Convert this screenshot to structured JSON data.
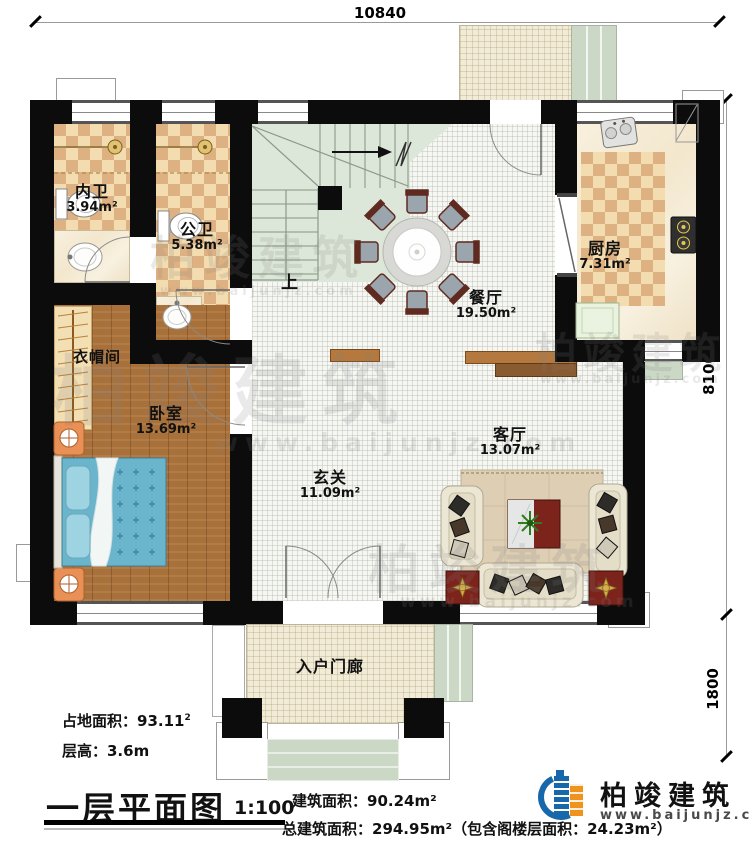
{
  "dims": {
    "top": "10840",
    "right_up": "8100",
    "right_low": "1800"
  },
  "rooms": [
    {
      "name": "内卫",
      "area": "3.94m²"
    },
    {
      "name": "公卫",
      "area": "5.38m²"
    },
    {
      "name": "厨房",
      "area": "7.31m²"
    },
    {
      "name": "餐厅",
      "area": "19.50m²"
    },
    {
      "name": "衣帽间",
      "area": ""
    },
    {
      "name": "卧室",
      "area": "13.69m²"
    },
    {
      "name": "玄关",
      "area": "11.09m²"
    },
    {
      "name": "客厅",
      "area": "13.07m²"
    },
    {
      "name": "入户门廊",
      "area": ""
    }
  ],
  "stairs_up": "上",
  "footer": {
    "land_area": "占地面积：93.11",
    "land_area_sup": "2",
    "floor_height": "层高：3.6m",
    "title": "一层平面图",
    "scale": "1:100",
    "building_area": "建筑面积：90.24m²",
    "total_area": "总建筑面积：294.95m²（包含阁楼层面积：24.23m²）"
  },
  "brand": {
    "name": "柏竣建筑",
    "url": "www.baijunjz.com"
  },
  "colors": {
    "accent_blue": "#1668ab",
    "accent_orange": "#f0921e",
    "wall": "#0c0c0c"
  }
}
